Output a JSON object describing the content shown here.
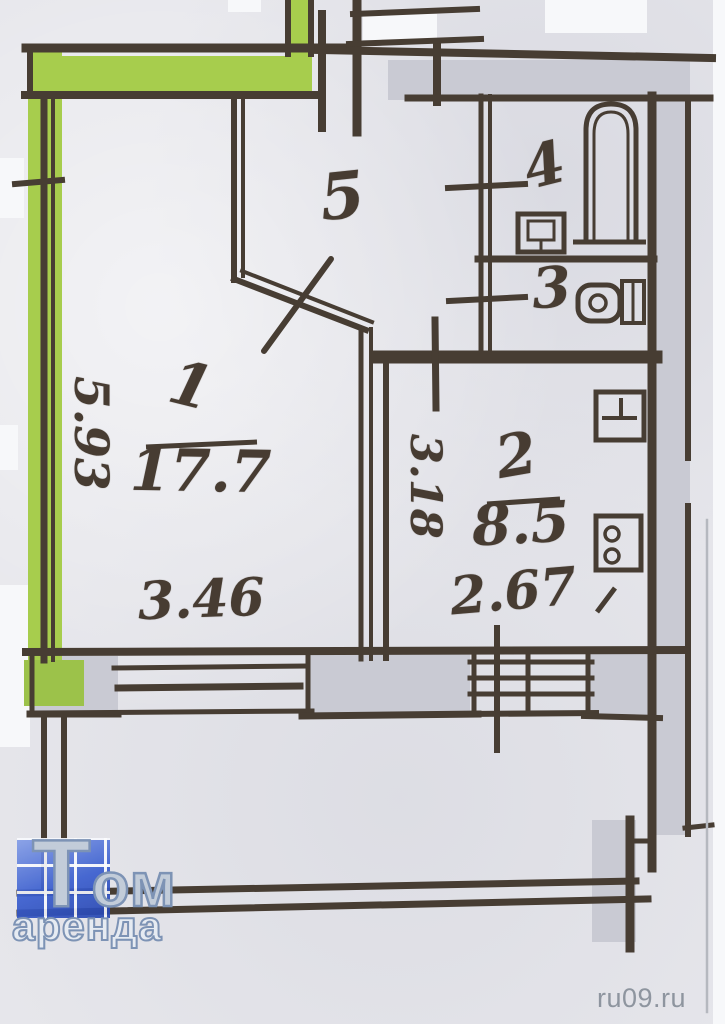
{
  "plan": {
    "rooms": {
      "room1": {
        "number": "1",
        "area": "17.7",
        "dim_bottom": "3.46",
        "dim_left": "5.93"
      },
      "room2": {
        "number": "2",
        "area": "8.5",
        "dim_bottom": "2.67",
        "dim_left": "3.18"
      },
      "room3": {
        "number": "3"
      },
      "room4": {
        "number": "4"
      },
      "room5": {
        "number": "5"
      }
    },
    "icons": {
      "bathtub": "bathtub-icon",
      "bathroom_sink": "sink-icon",
      "toilet": "toilet-icon",
      "kitchen_sink": "kitchen-sink-icon",
      "stove": "stove-icon"
    },
    "colors": {
      "wall_highlight_green": "#a7cd4d",
      "ink": "#473d33",
      "wall_fill": "#c9cad3",
      "paper": "#e6e6eb"
    }
  },
  "branding": {
    "logo_line1": "Том",
    "logo_line2": "аренда",
    "watermark": "ru09.ru",
    "logo_blue": "#3a5ecf",
    "logo_letter_color": "#c2ccd9",
    "watermark_color": "#8e959f"
  }
}
